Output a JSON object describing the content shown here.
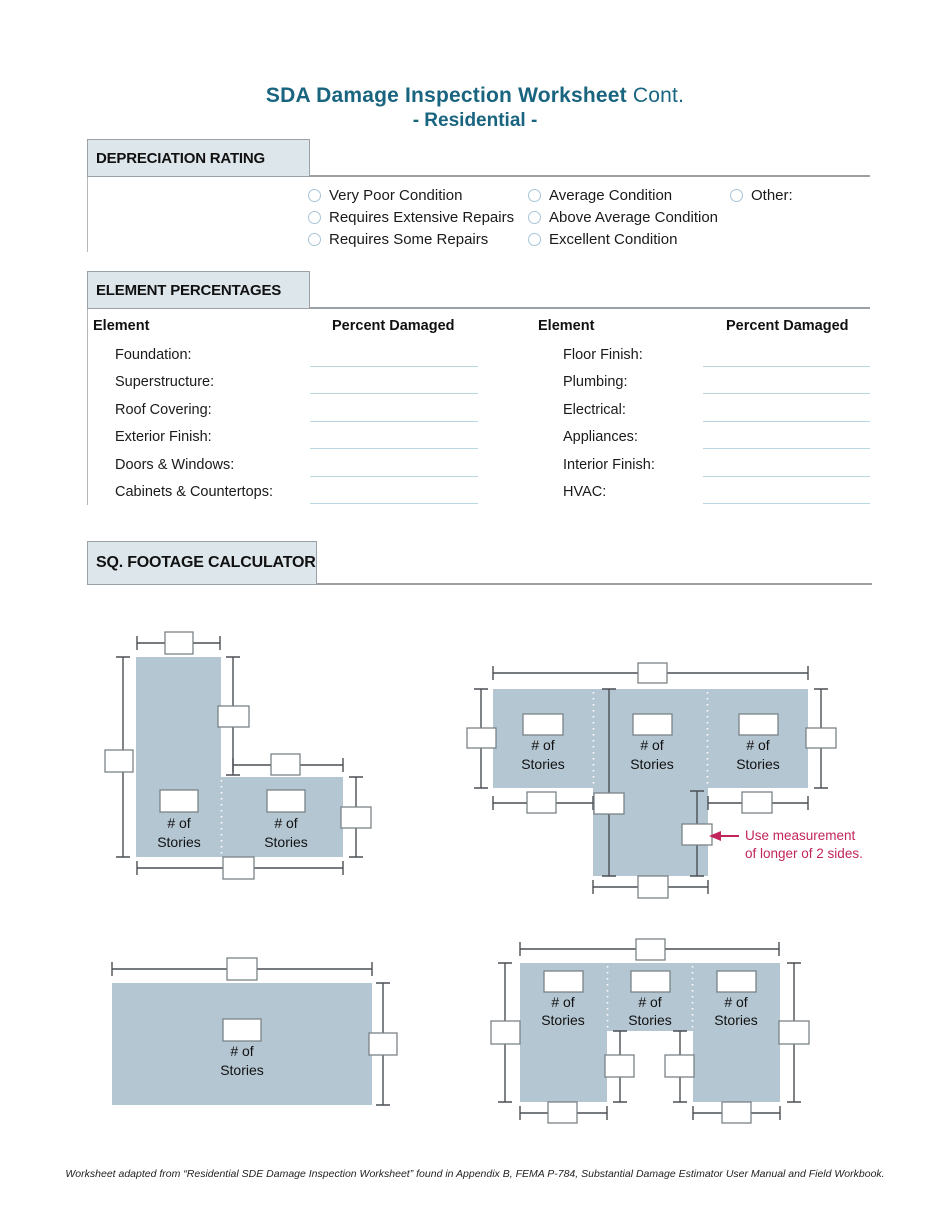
{
  "page": {
    "title_main": "SDA Damage Inspection Worksheet",
    "title_cont": "Cont.",
    "title_sub": "- Residential -",
    "footer": "Worksheet adapted from “Residential SDE Damage Inspection Worksheet” found in Appendix B, FEMA P-784,  Substantial Damage Estimator User Manual and Field Workbook."
  },
  "depreciation": {
    "section_label": "DEPRECIATION RATING",
    "col1": [
      "Very Poor Condition",
      "Requires Extensive Repairs",
      "Requires Some Repairs"
    ],
    "col2": [
      "Average Condition",
      "Above Average Condition",
      "Excellent Condition"
    ],
    "col3": [
      "Other:"
    ]
  },
  "elements": {
    "section_label": "ELEMENT PERCENTAGES",
    "header_element_left": "Element",
    "header_percent_left": "Percent Damaged",
    "header_element_right": "Element",
    "header_percent_right": "Percent Damaged",
    "left_labels": [
      "Foundation:",
      "Superstructure:",
      "Roof Covering:",
      "Exterior Finish:",
      "Doors & Windows:",
      "Cabinets & Countertops:"
    ],
    "right_labels": [
      "Floor Finish:",
      "Plumbing:",
      "Electrical:",
      "Appliances:",
      "Interior Finish:",
      "HVAC:"
    ],
    "field_value": ""
  },
  "sqft": {
    "section_label": "SQ. FOOTAGE CALCULATOR",
    "stories_line1": "# of",
    "stories_line2": "Stories",
    "note_line1": "Use measurement",
    "note_line2": "of longer of 2 sides.",
    "dimension_box_value": ""
  },
  "colors": {
    "title_teal": "#19647F",
    "tab_bg": "#DCE6EB",
    "building_fill": "#B4C6D2",
    "note_pink": "#C2255C",
    "field_underline": "#B9D6E3",
    "dimension_line": "#4A4F54"
  }
}
